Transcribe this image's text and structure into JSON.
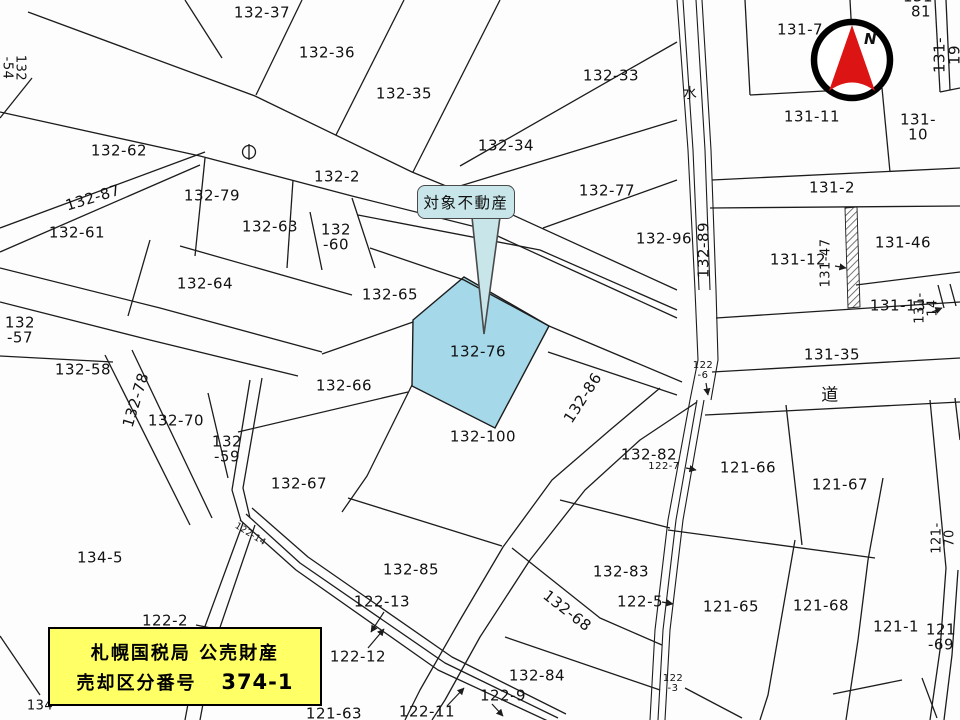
{
  "map": {
    "callout_label": "対象不動産",
    "compass_label": "N",
    "notice": {
      "line1": "札幌国税局 公売財産",
      "line2_label": "売却区分番号",
      "line2_number": "374-1"
    },
    "colors": {
      "bg": "#fdfdfd",
      "line": "#1c1c1c",
      "highlight": "#a5d8e9",
      "callout": "#c8e6ea",
      "notice": "#ffff66",
      "compass_red": "#dd1414"
    },
    "target_parcel": "132-76",
    "parcel_labels": [
      {
        "t": "132-37",
        "x": 262,
        "y": 13
      },
      {
        "t": "132-36",
        "x": 327,
        "y": 53
      },
      {
        "t": "132-35",
        "x": 404,
        "y": 94
      },
      {
        "t": "132-33",
        "x": 611,
        "y": 76
      },
      {
        "t": "132-34",
        "x": 506,
        "y": 146
      },
      {
        "t": "132-62",
        "x": 119,
        "y": 151
      },
      {
        "t": "132-2",
        "x": 337,
        "y": 177
      },
      {
        "t": "132-77",
        "x": 607,
        "y": 191
      },
      {
        "t": "132-79",
        "x": 212,
        "y": 196
      },
      {
        "t": "132-87",
        "x": 93,
        "y": 198,
        "rot": -17
      },
      {
        "t": "132-63",
        "x": 270,
        "y": 227
      },
      {
        "t": "132\n-60",
        "x": 336,
        "y": 237
      },
      {
        "t": "132-61",
        "x": 77,
        "y": 233
      },
      {
        "t": "132-96",
        "x": 664,
        "y": 239
      },
      {
        "t": "132-64",
        "x": 205,
        "y": 284
      },
      {
        "t": "132-65",
        "x": 390,
        "y": 295
      },
      {
        "t": "132\n-57",
        "x": 20,
        "y": 330
      },
      {
        "t": "132-76",
        "x": 478,
        "y": 352
      },
      {
        "t": "131-35",
        "x": 832,
        "y": 355
      },
      {
        "t": "132-58",
        "x": 83,
        "y": 370
      },
      {
        "t": "132-66",
        "x": 344,
        "y": 386
      },
      {
        "t": "道",
        "x": 830,
        "y": 396,
        "fs": 17
      },
      {
        "t": "132-70",
        "x": 176,
        "y": 421
      },
      {
        "t": "132-100",
        "x": 483,
        "y": 437
      },
      {
        "t": "132\n-59",
        "x": 227,
        "y": 449
      },
      {
        "t": "132-82",
        "x": 649,
        "y": 455
      },
      {
        "t": "121-66",
        "x": 748,
        "y": 468
      },
      {
        "t": "132-67",
        "x": 299,
        "y": 484
      },
      {
        "t": "121-67",
        "x": 840,
        "y": 485
      },
      {
        "t": "134-5",
        "x": 100,
        "y": 558
      },
      {
        "t": "132-85",
        "x": 411,
        "y": 570
      },
      {
        "t": "132-83",
        "x": 621,
        "y": 572
      },
      {
        "t": "122-13",
        "x": 382,
        "y": 602
      },
      {
        "t": "122-5",
        "x": 640,
        "y": 602
      },
      {
        "t": "121-65",
        "x": 731,
        "y": 607
      },
      {
        "t": "121-68",
        "x": 821,
        "y": 606
      },
      {
        "t": "122-2",
        "x": 165,
        "y": 621
      },
      {
        "t": "121-1",
        "x": 896,
        "y": 627
      },
      {
        "t": "121\n-69",
        "x": 941,
        "y": 637
      },
      {
        "t": "122-12",
        "x": 358,
        "y": 657
      },
      {
        "t": "132-84",
        "x": 537,
        "y": 676
      },
      {
        "t": "122\n-3",
        "x": 673,
        "y": 684,
        "fs": 10
      },
      {
        "t": "122-9",
        "x": 503,
        "y": 696
      },
      {
        "t": "122-11",
        "x": 427,
        "y": 712
      },
      {
        "t": "121-63",
        "x": 334,
        "y": 714
      },
      {
        "t": "134",
        "x": 40,
        "y": 707,
        "fs": 13
      },
      {
        "t": "131-81",
        "x": 921,
        "y": 4
      },
      {
        "t": "131-7",
        "x": 800,
        "y": 30
      },
      {
        "t": "131-11",
        "x": 812,
        "y": 117
      },
      {
        "t": "131-10",
        "x": 918,
        "y": 127
      },
      {
        "t": "131-2",
        "x": 832,
        "y": 188
      },
      {
        "t": "131-12",
        "x": 798,
        "y": 260
      },
      {
        "t": "131-46",
        "x": 903,
        "y": 243
      },
      {
        "t": "131-13",
        "x": 898,
        "y": 306
      },
      {
        "t": "水",
        "x": 690,
        "y": 95,
        "fs": 14
      },
      {
        "t": "132-89",
        "x": 704,
        "y": 250,
        "rot": -90
      },
      {
        "t": "131-47",
        "x": 827,
        "y": 263,
        "rot": -90,
        "fs": 13
      },
      {
        "t": "131-14",
        "x": 927,
        "y": 308,
        "rot": -90,
        "fs": 13
      },
      {
        "t": "131-19",
        "x": 947,
        "y": 55,
        "rot": -90
      },
      {
        "t": "121-70",
        "x": 944,
        "y": 538,
        "rot": -90,
        "fs": 13
      },
      {
        "t": "132\n-54",
        "x": 13,
        "y": 68,
        "rot": 90,
        "fs": 13
      },
      {
        "t": "132-78",
        "x": 136,
        "y": 400,
        "rot": -73
      },
      {
        "t": "132-86",
        "x": 583,
        "y": 398,
        "rot": -57
      },
      {
        "t": "132-68",
        "x": 567,
        "y": 611,
        "rot": 38
      },
      {
        "t": "122\n-6",
        "x": 703,
        "y": 371,
        "fs": 10
      },
      {
        "t": "122-7",
        "x": 664,
        "y": 467,
        "fs": 10
      },
      {
        "t": "122-14",
        "x": 250,
        "y": 535,
        "fs": 9,
        "rot": 32
      }
    ]
  }
}
